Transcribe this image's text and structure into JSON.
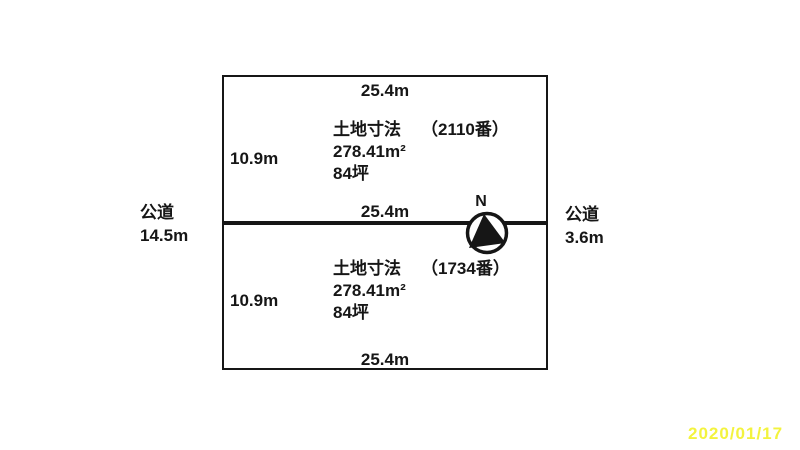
{
  "diagram": {
    "background": "#ffffff",
    "line_color": "#161616",
    "north_label": "N",
    "date_stamp": {
      "text": "2020/01/17",
      "color": "#f3f33e"
    },
    "roads": {
      "left": {
        "label": "公道",
        "width": "14.5m"
      },
      "right": {
        "label": "公道",
        "width": "3.6m"
      }
    },
    "edge_widths": {
      "top": "25.4m",
      "middle": "25.4m",
      "bottom": "25.4m"
    },
    "parcels": [
      {
        "title": "土地寸法",
        "lot_number": "（2110番）",
        "area_sqm": "278.41m²",
        "area_tsubo": "84坪",
        "side_length": "10.9m"
      },
      {
        "title": "土地寸法",
        "lot_number": "（1734番）",
        "area_sqm": "278.41m²",
        "area_tsubo": "84坪",
        "side_length": "10.9m"
      }
    ]
  }
}
